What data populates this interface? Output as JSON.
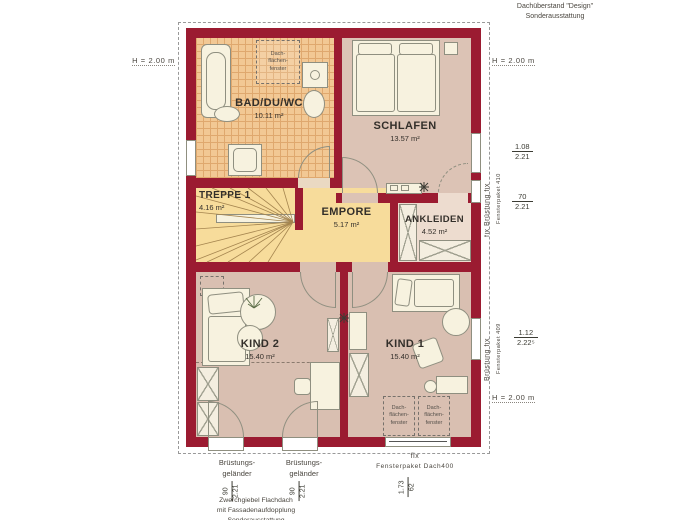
{
  "title_block": {
    "roof_overhang_line1": "Dachüberstand \"Design\"",
    "roof_overhang_line2": "Sonderausstattung",
    "footer_line1": "Zwerchgiebel Flachdach",
    "footer_line2": "mit Fassadenaufdopplung",
    "footer_line3": "Sonderausstattung"
  },
  "rooms": [
    {
      "name": "BAD/DU/WC",
      "area": "10.11 m²"
    },
    {
      "name": "SCHLAFEN",
      "area": "13.57 m²"
    },
    {
      "name": "TREPPE 1",
      "area": "4.16 m²"
    },
    {
      "name": "EMPORE",
      "area": "5.17 m²"
    },
    {
      "name": "ANKLEIDEN",
      "area": "4.52 m²"
    },
    {
      "name": "KIND 2",
      "area": "15.40 m²"
    },
    {
      "name": "KIND 1",
      "area": "15.40 m²"
    }
  ],
  "roof_window": [
    "Dach-",
    "flächen-",
    "fenster"
  ],
  "heights": {
    "left": "H = 2.00 m",
    "right_top": "H = 2.00 m",
    "right_bottom": "H = 2.00 m"
  },
  "windows": {
    "w410": {
      "label": "fix  Brüstung  fix",
      "package": "Fensterpaket 410",
      "dim_top": {
        "num": "1.08",
        "den": "2.21"
      },
      "dim_bottom": {
        "num": "70",
        "den": "2.21"
      }
    },
    "w409": {
      "label": "Brüstung  fix",
      "package": "Fensterpaket 409",
      "dim": {
        "num": "1.12",
        "den": "2.22⁵"
      }
    },
    "dach400": {
      "fix": "fix",
      "package": "Fensterpaket Dach400",
      "dim": {
        "num": "1.73",
        "den": "62"
      }
    }
  },
  "railings": {
    "label_line1": "Brüstungs-",
    "label_line2": "geländer",
    "dim": {
      "num": "90",
      "den": "2.21"
    }
  },
  "colors": {
    "wall": "#9b1b31",
    "tile": "#f2c894",
    "gallery": "#f7dc9b",
    "floor": "#d9bfb1",
    "furniture": "#f7f2df"
  }
}
